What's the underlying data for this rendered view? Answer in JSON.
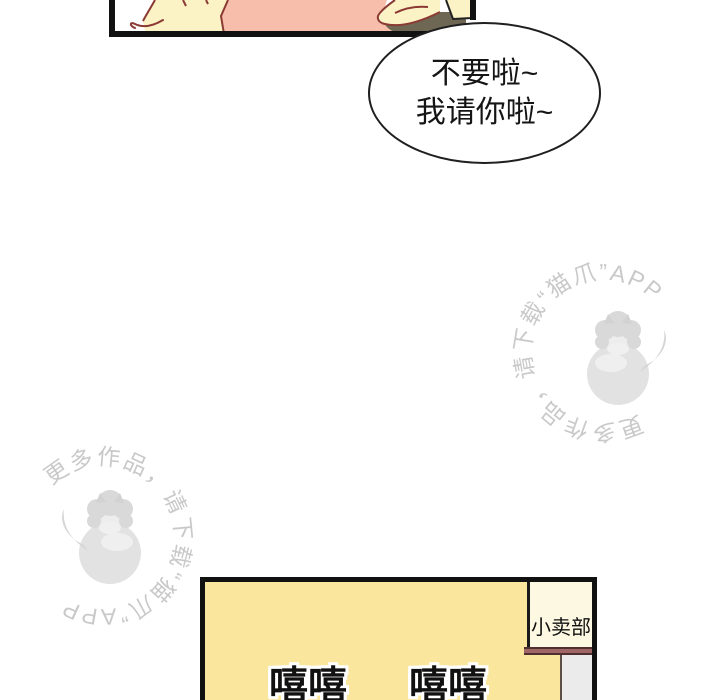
{
  "speech_bubble": {
    "lines": [
      "不要啦~",
      "我请你啦~"
    ]
  },
  "watermark": {
    "text": "更多作品，请下载“猫爪”APP",
    "illustration": "catgirl-hugging-ball-icon",
    "color": "#c9c9c9"
  },
  "shop": {
    "sign": "小卖部",
    "giggles": [
      "嘻嘻",
      "嘻嘻"
    ]
  },
  "colors": {
    "panel_border": "#111111",
    "skin_cream": "#fbf2c6",
    "shirt_pink": "#f7bfab",
    "shadow_olive": "#6e6754",
    "line_red": "#8b3a33",
    "shop_yellow": "#fae69c",
    "sign_cream": "#fcf8e1",
    "awning_maroon": "#a06565",
    "wall_gray": "#ebebeb"
  }
}
